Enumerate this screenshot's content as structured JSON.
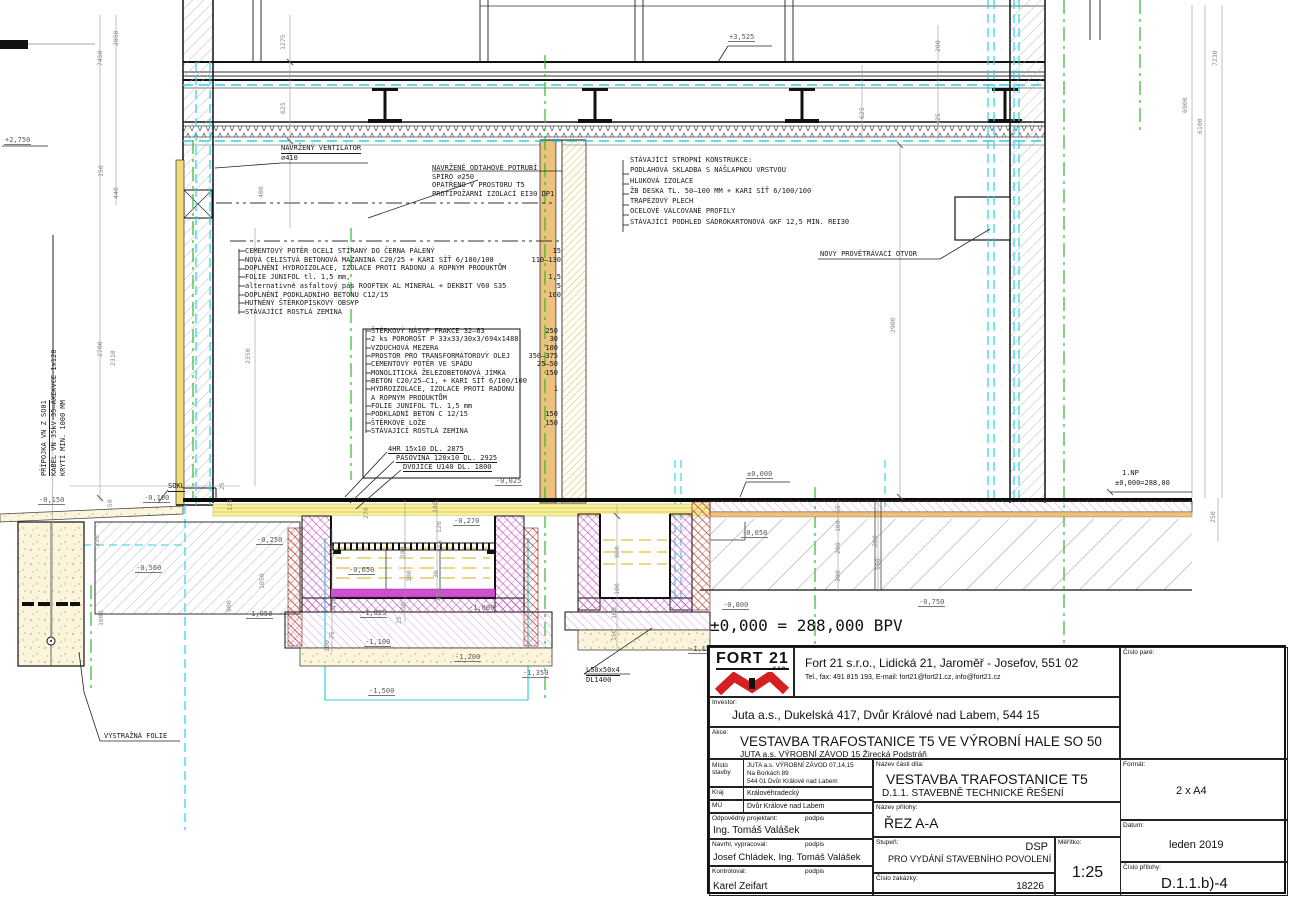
{
  "drawing": {
    "bpv_text": "±0,000 = 288,000 BPV",
    "floor_layers": [
      {
        "t": "CEMENTOVÝ POTĚR OCELI STÍRANÝ DO ČERNA PÁLENÝ",
        "d": "15"
      },
      {
        "t": "NOVÁ CELISTVÁ BETONOVÁ MAZANINA C20/25 + KARI SÍŤ 6/100/100",
        "d": "110–130"
      },
      {
        "t": "DOPLNĚNÍ HYDROIZOLACE, IZOLACE PROTI RADONU A ROPNÝM PRODUKTŮM",
        "d": ""
      },
      {
        "t": "FOLIE JUNIFOL tl. 1,5 mm,",
        "d": "1,5"
      },
      {
        "t": "alternativně asfaltový pás ROOFTEK AL MINERAL + DEKBIT V60 S35",
        "d": "5"
      },
      {
        "t": "DOPLNĚNÍ PODKLADNÍHO BETONU C12/15",
        "d": "100"
      },
      {
        "t": "HUTNĚNÝ ŠTĚRKOPÍSKOVÝ OBSYP",
        "d": ""
      },
      {
        "t": "STÁVAJÍCÍ ROSTLÁ ZEMINA",
        "d": ""
      }
    ],
    "pit_layers": [
      {
        "t": "ŠTĚRKOVÝ NÁSYP FRAKCE 32–63",
        "d": "250"
      },
      {
        "t": "2 ks POROROŠT P 33x33/30x3/694x1488",
        "d": "30"
      },
      {
        "t": "VZDUCHOVÁ MEZERA",
        "d": "100"
      },
      {
        "t": "PROSTOR PRO TRANSFORMÁTOROVÝ OLEJ",
        "d": "350–375"
      },
      {
        "t": "CEMENTOVÝ POTĚR VE SPÁDU",
        "d": "25–50"
      },
      {
        "t": "MONOLITICKÁ ŽELEZOBETONOVÁ JÍMKA",
        "d": "150"
      },
      {
        "t": "BETON C20/25–C1, + KARI SÍŤ 6/100/100",
        "d": ""
      },
      {
        "t": "HYDROIZOLACE, IZOLACE PROTI RADONU",
        "d": "1"
      },
      {
        "t": "A ROPNÝM PRODUKTŮM",
        "d": ""
      },
      {
        "t": "FOLIE JUNIFOL TL. 1,5 mm",
        "d": ""
      },
      {
        "t": "PODKLADNÍ BETON C 12/15",
        "d": "150"
      },
      {
        "t": "ŠTĚRKOVÉ LOŽE",
        "d": "150"
      },
      {
        "t": "STÁVAJÍCÍ ROSTLÁ ZEMINA",
        "d": ""
      }
    ],
    "steel_items": [
      "4HR 15x10 DL. 2875",
      "PÁSOVINA 120x10 DL. 2925",
      "DVOJICE U140 DL. 1800"
    ],
    "ceiling_list": {
      "title": "STÁVAJÍCÍ STROPNÍ KONSTRUKCE:",
      "items": [
        "PODLAHOVÁ SKLADBA S NÁŠLAPNOU VRSTVOU",
        "HLUKOVÁ IZOLACE",
        "ŽB DESKA TL. 50–100 MM + KARI SÍŤ 6/100/100",
        "TRAPÉZOVÝ PLECH",
        "OCELOVÉ VÁLCOVANÉ PROFILY",
        "STÁVAJÍCÍ PODHLED SÁDROKARTONOVÁ GKF 12,5 MIN. REI30"
      ]
    },
    "vent_note": [
      "NAVRŽENÝ VENTILÁTOR",
      "⌀410"
    ],
    "duct_note": [
      "NAVRŽENÉ ODTAHOVÉ POTRUBÍ",
      "SPIRO ⌀250",
      "OPATŘENO V PROSTORU T5",
      "PROTIPOŽÁRNÍ IZOLACÍ EI30 DP1"
    ],
    "cable_note": [
      "PŘÍPOJKA VN Z SO01",
      "KABEL VN 35kV 35–AXEKVCE 1x120",
      "KRYTÍ MIN. 1000 MM"
    ],
    "labels": {
      "otvor": "NOVÝ PROVĚTRÁVACÍ OTVOR",
      "sokl": "SOKL",
      "warning_foil": "VÝSTRAŽNÁ FOLIE",
      "np": "1.NP",
      "np_level": "±0,000=288,00",
      "l_profile": "L50x50x4",
      "l_profile_len": "DL1400"
    },
    "levels": [
      {
        "t": "+2,750",
        "x": 4,
        "y": 136
      },
      {
        "t": "+3,525",
        "x": 728,
        "y": 33
      },
      {
        "t": "±0,000",
        "x": 746,
        "y": 470
      },
      {
        "t": "-0,025",
        "x": 495,
        "y": 477
      },
      {
        "t": "-0,050",
        "x": 741,
        "y": 529
      },
      {
        "t": "-0,100",
        "x": 143,
        "y": 494
      },
      {
        "t": "-0,150",
        "x": 38,
        "y": 496
      },
      {
        "t": "-0,250",
        "x": 256,
        "y": 536
      },
      {
        "t": "-0,270",
        "x": 453,
        "y": 517
      },
      {
        "t": "-0,560",
        "x": 135,
        "y": 564
      },
      {
        "t": "-0,650",
        "x": 348,
        "y": 566
      },
      {
        "t": "-0,750",
        "x": 918,
        "y": 598
      },
      {
        "t": "-0,800",
        "x": 722,
        "y": 601
      },
      {
        "t": "-1,000",
        "x": 468,
        "y": 604
      },
      {
        "t": "-1,025",
        "x": 360,
        "y": 609
      },
      {
        "t": "-1,050",
        "x": 246,
        "y": 610
      },
      {
        "t": "-1,100",
        "x": 364,
        "y": 638
      },
      {
        "t": "-1,150",
        "x": 688,
        "y": 645
      },
      {
        "t": "-1,200",
        "x": 454,
        "y": 653
      },
      {
        "t": "-1,350",
        "x": 522,
        "y": 669
      },
      {
        "t": "-1,500",
        "x": 368,
        "y": 687
      }
    ],
    "dims": [
      {
        "t": "7450",
        "x": 96,
        "y": 66
      },
      {
        "t": "2050",
        "x": 112,
        "y": 46
      },
      {
        "t": "1275",
        "x": 279,
        "y": 50
      },
      {
        "t": "625",
        "x": 279,
        "y": 114
      },
      {
        "t": "400",
        "x": 257,
        "y": 198
      },
      {
        "t": "150",
        "x": 97,
        "y": 177
      },
      {
        "t": "440",
        "x": 112,
        "y": 199
      },
      {
        "t": "2700",
        "x": 96,
        "y": 357
      },
      {
        "t": "2310",
        "x": 109,
        "y": 366
      },
      {
        "t": "2350",
        "x": 244,
        "y": 364
      },
      {
        "t": "625",
        "x": 858,
        "y": 119
      },
      {
        "t": "425",
        "x": 934,
        "y": 125
      },
      {
        "t": "200",
        "x": 934,
        "y": 52
      },
      {
        "t": "2900",
        "x": 889,
        "y": 333
      },
      {
        "t": "6900",
        "x": 1181,
        "y": 113
      },
      {
        "t": "6100",
        "x": 1196,
        "y": 134
      },
      {
        "t": "7230",
        "x": 1211,
        "y": 66
      },
      {
        "t": "550",
        "x": 328,
        "y": 557
      },
      {
        "t": "270",
        "x": 362,
        "y": 519
      },
      {
        "t": "140",
        "x": 431,
        "y": 513
      },
      {
        "t": "120",
        "x": 435,
        "y": 533
      },
      {
        "t": "280",
        "x": 399,
        "y": 558
      },
      {
        "t": "250",
        "x": 436,
        "y": 552
      },
      {
        "t": "100",
        "x": 405,
        "y": 582
      },
      {
        "t": "30",
        "x": 432,
        "y": 578
      },
      {
        "t": "475",
        "x": 330,
        "y": 609
      },
      {
        "t": "350",
        "x": 399,
        "y": 614
      },
      {
        "t": "450",
        "x": 435,
        "y": 601
      },
      {
        "t": "25",
        "x": 395,
        "y": 624
      },
      {
        "t": "75",
        "x": 328,
        "y": 639
      },
      {
        "t": "100",
        "x": 323,
        "y": 652
      },
      {
        "t": "800",
        "x": 613,
        "y": 558
      },
      {
        "t": "100",
        "x": 613,
        "y": 595
      },
      {
        "t": "100",
        "x": 610,
        "y": 619
      },
      {
        "t": "150",
        "x": 610,
        "y": 641
      },
      {
        "t": "65",
        "x": 834,
        "y": 513
      },
      {
        "t": "100",
        "x": 834,
        "y": 532
      },
      {
        "t": "200",
        "x": 834,
        "y": 554
      },
      {
        "t": "300",
        "x": 834,
        "y": 582
      },
      {
        "t": "200",
        "x": 871,
        "y": 547
      },
      {
        "t": "500",
        "x": 874,
        "y": 570
      },
      {
        "t": "250",
        "x": 1209,
        "y": 523
      },
      {
        "t": "150",
        "x": 106,
        "y": 511
      },
      {
        "t": "350",
        "x": 93,
        "y": 547
      },
      {
        "t": "1000",
        "x": 97,
        "y": 626
      },
      {
        "t": "900",
        "x": 225,
        "y": 612
      },
      {
        "t": "1050",
        "x": 258,
        "y": 589
      },
      {
        "t": "25",
        "x": 218,
        "y": 490
      },
      {
        "t": "125",
        "x": 226,
        "y": 511
      }
    ]
  },
  "titleblock": {
    "logo_text": "FORT 21",
    "logo_sub": "s.r.o.",
    "company_line1": "Fort 21 s.r.o., Lidická 21, Jaroměř - Josefov, 551 02",
    "company_line2": "Tel., fax: 491 815 193,  E-mail: fort21@fort21.cz, info@fort21.cz",
    "cislo_pare_label": "Číslo paré:",
    "investor_label": "Investor:",
    "investor": "Juta a.s., Dukelská 417, Dvůr Králové nad Labem, 544 15",
    "akce_label": "Akce:",
    "akce": "VESTAVBA TRAFOSTANICE T5 VE VÝROBNÍ HALE SO 50",
    "akce_sub": "JUTA a.s. VÝROBNÍ ZÁVOD 15 Žirecká Podstráň",
    "misto_label": "Místo stavby",
    "misto_line1": "JUTA a.s. VÝROBNÍ ZÁVOD 07,14,15",
    "misto_line2": "Na Borkách 89",
    "misto_line3": "544 01 Dvůr Králové nad Labem",
    "kraj_label": "Kraj",
    "kraj": "Královéhradecký",
    "mu_label": "MÚ",
    "mu": "Dvůr Králové nad Labem",
    "odp_label": "Odpovědný projektant:",
    "podpis_label": "podpis",
    "odp": "Ing. Tomáš Valášek",
    "nav_label": "Navrhl, vypracoval:",
    "nav": "Josef Chládek, Ing. Tomáš Valášek",
    "kon_label": "Kontroloval:",
    "kon": "Karel Zeifart",
    "ncd_label": "Název části díla:",
    "ncd1": "VESTAVBA TRAFOSTANICE T5",
    "ncd2": "D.1.1. STAVEBNĚ TECHNICKÉ ŘEŠENÍ",
    "npr_label": "Název přílohy:",
    "npr": "ŘEZ A-A",
    "stu_label": "Stupeň:",
    "stu_dsp": "DSP",
    "stu": "PRO VYDÁNÍ STAVEBNÍHO POVOLENÍ",
    "cz_label": "Číslo zakázky:",
    "cz": "18226",
    "mer_label": "Měřítko:",
    "mer": "1:25",
    "fmt_label": "Formát:",
    "fmt": "2 x A4",
    "dat_label": "Datum:",
    "dat": "leden 2019",
    "cp_label": "Číslo přílohy:",
    "cp": "D.1.1.b)-4"
  },
  "colors": {
    "cyan": "#29d2e3",
    "green": "#2eb82e",
    "yellow_band": "#f7f0a2",
    "tan": "#ecc27c",
    "pink_hatch": "#e09ad8",
    "magenta_cross": "#c75fc7",
    "red_cross": "#bf3b30",
    "logo_red": "#d42020",
    "sand_dot": "#c9a254"
  }
}
